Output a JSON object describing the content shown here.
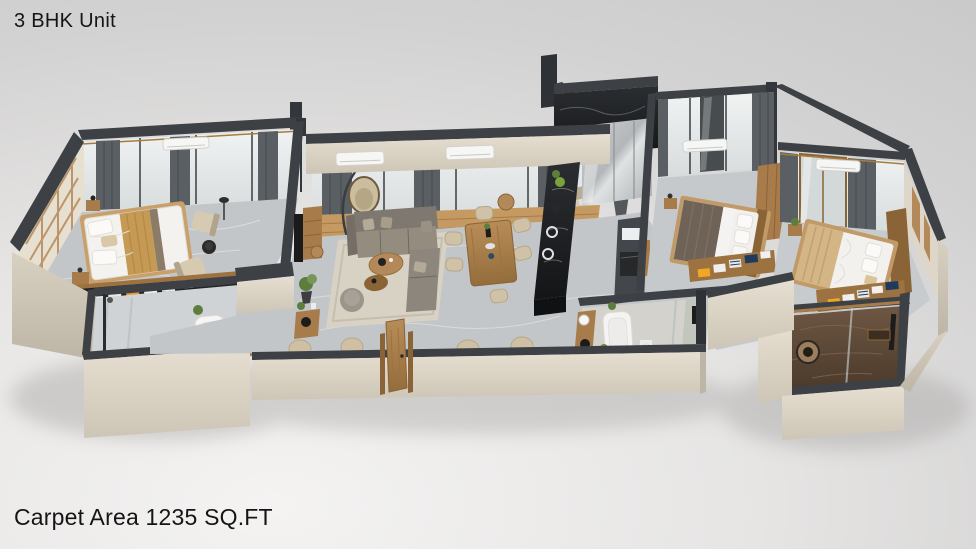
{
  "header": {
    "title": "3 BHK Unit"
  },
  "footer": {
    "area_label": "Carpet Area 1235 SQ.FT"
  },
  "floorplan": {
    "view": "3D axonometric render of apartment unit",
    "depicted_rooms": [
      "Master Bedroom",
      "En-suite Bathroom",
      "Balcony",
      "Living Room",
      "Dining Area",
      "Kitchen",
      "Common Bathroom",
      "Bedroom 2",
      "Bedroom 3",
      "Attached Bathroom",
      "Entry Foyer"
    ],
    "colors": {
      "wall_top": "#3d4145",
      "wall_face": "#ddd5c6",
      "floor_marble": "#c3c6c8",
      "wood": "#ab7d4a",
      "sofa_gray": "#8d867c",
      "curtain": "#5a5f63",
      "kitchen_marble": "#1a1c1e",
      "bath_brown": "#5e4a38",
      "cloth_navy": "#1f3a5c",
      "cloth_orange": "#e89a28",
      "plant_green": "#5d7d3f",
      "bed_white": "#f3f2ef"
    }
  }
}
